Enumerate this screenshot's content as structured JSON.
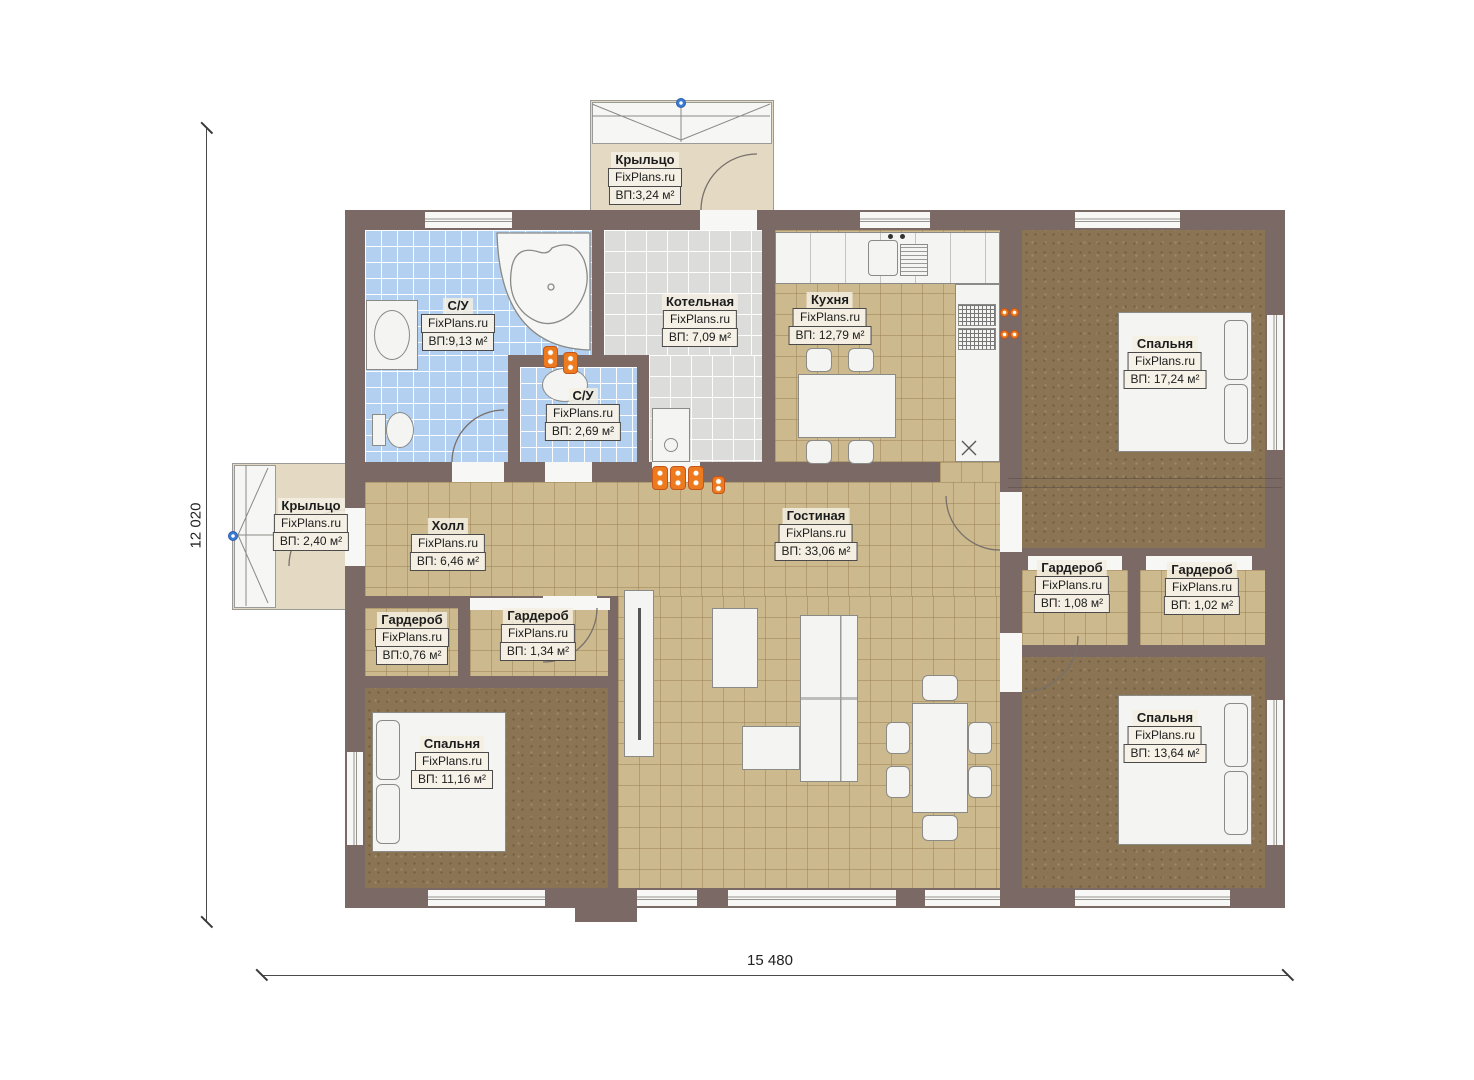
{
  "watermark": "FixPlans.ru",
  "dimensions": {
    "horizontal": "15 480",
    "vertical": "12 020"
  },
  "colors": {
    "wall": "#7b6966",
    "floor_tan": "#cdb98e",
    "floor_dark": "#8b7453",
    "tile_blue": "#b4d0f1",
    "tile_gray": "#dcdcda",
    "porch": "#e4d9c3",
    "outlet_orange": "#ee7a1f",
    "marker_blue": "#3a7bd5"
  },
  "rooms": [
    {
      "id": "porch-top",
      "name": "Крыльцо",
      "area": "ВП:3,24 м²"
    },
    {
      "id": "bathroom-large",
      "name": "С/У",
      "area": "ВП:9,13 м²"
    },
    {
      "id": "boiler-room",
      "name": "Котельная",
      "area": "ВП: 7,09 м²"
    },
    {
      "id": "kitchen",
      "name": "Кухня",
      "area": "ВП: 12,79 м²"
    },
    {
      "id": "bedroom-top-right",
      "name": "Спальня",
      "area": "ВП: 17,24 м²"
    },
    {
      "id": "porch-left",
      "name": "Крыльцо",
      "area": "ВП: 2,40 м²"
    },
    {
      "id": "bathroom-small",
      "name": "С/У",
      "area": "ВП: 2,69 м²"
    },
    {
      "id": "hall",
      "name": "Холл",
      "area": "ВП: 6,46 м²"
    },
    {
      "id": "living-room",
      "name": "Гостиная",
      "area": "ВП: 33,06 м²"
    },
    {
      "id": "wardrobe-right-1",
      "name": "Гардероб",
      "area": "ВП: 1,08 м²"
    },
    {
      "id": "wardrobe-right-2",
      "name": "Гардероб",
      "area": "ВП: 1,02 м²"
    },
    {
      "id": "wardrobe-left-1",
      "name": "Гардероб",
      "area": "ВП:0,76 м²"
    },
    {
      "id": "wardrobe-left-2",
      "name": "Гардероб",
      "area": "ВП: 1,34 м²"
    },
    {
      "id": "bedroom-bottom-left",
      "name": "Спальня",
      "area": "ВП: 11,16 м²"
    },
    {
      "id": "bedroom-bottom-right",
      "name": "Спальня",
      "area": "ВП: 13,64 м²"
    }
  ]
}
